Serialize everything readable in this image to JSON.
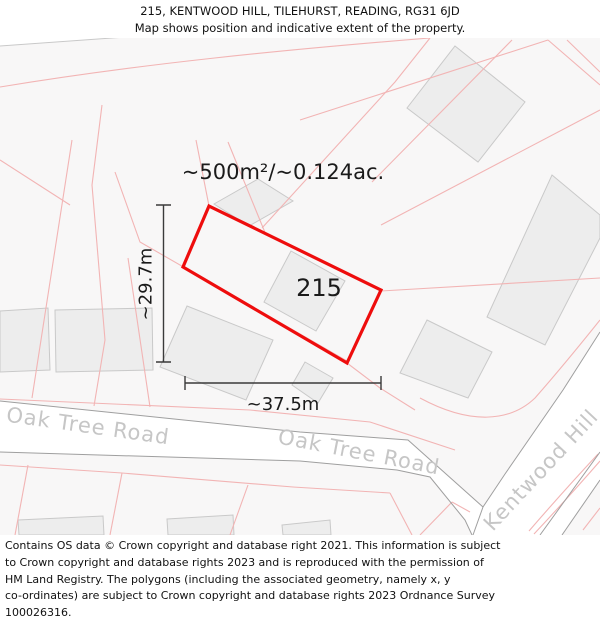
{
  "header": {
    "title": "215, KENTWOOD HILL, TILEHURST, READING, RG31 6JD",
    "subtitle": "Map shows position and indicative extent of the property."
  },
  "map": {
    "plot_number": "215",
    "area_label": "~500m²/~0.124ac.",
    "width_label": "~37.5m",
    "height_label": "~29.7m",
    "road_labels": {
      "oak_tree_road_west": "Oak Tree Road",
      "oak_tree_road_east": "Oak Tree Road",
      "kentwood_hill": "Kentwood Hill"
    },
    "colors": {
      "property_outline": "#ee0d0d",
      "parcel_line": "#f2b4b4",
      "road_edge": "#9f9f9f",
      "road_fill": "#ffffff",
      "building_fill": "#ededed",
      "building_stroke": "#c9c9c9",
      "road_label_text": "#c6c6c6",
      "map_background": "#f8f7f7",
      "dimension_line": "#3a3a3a"
    }
  },
  "footer": {
    "lines": [
      "Contains OS data © Crown copyright and database right 2021. This information is subject",
      "to Crown copyright and database rights 2023 and is reproduced with the permission of",
      "HM Land Registry. The polygons (including the associated geometry, namely x, y",
      "co-ordinates) are subject to Crown copyright and database rights 2023 Ordnance Survey",
      "100026316."
    ]
  }
}
